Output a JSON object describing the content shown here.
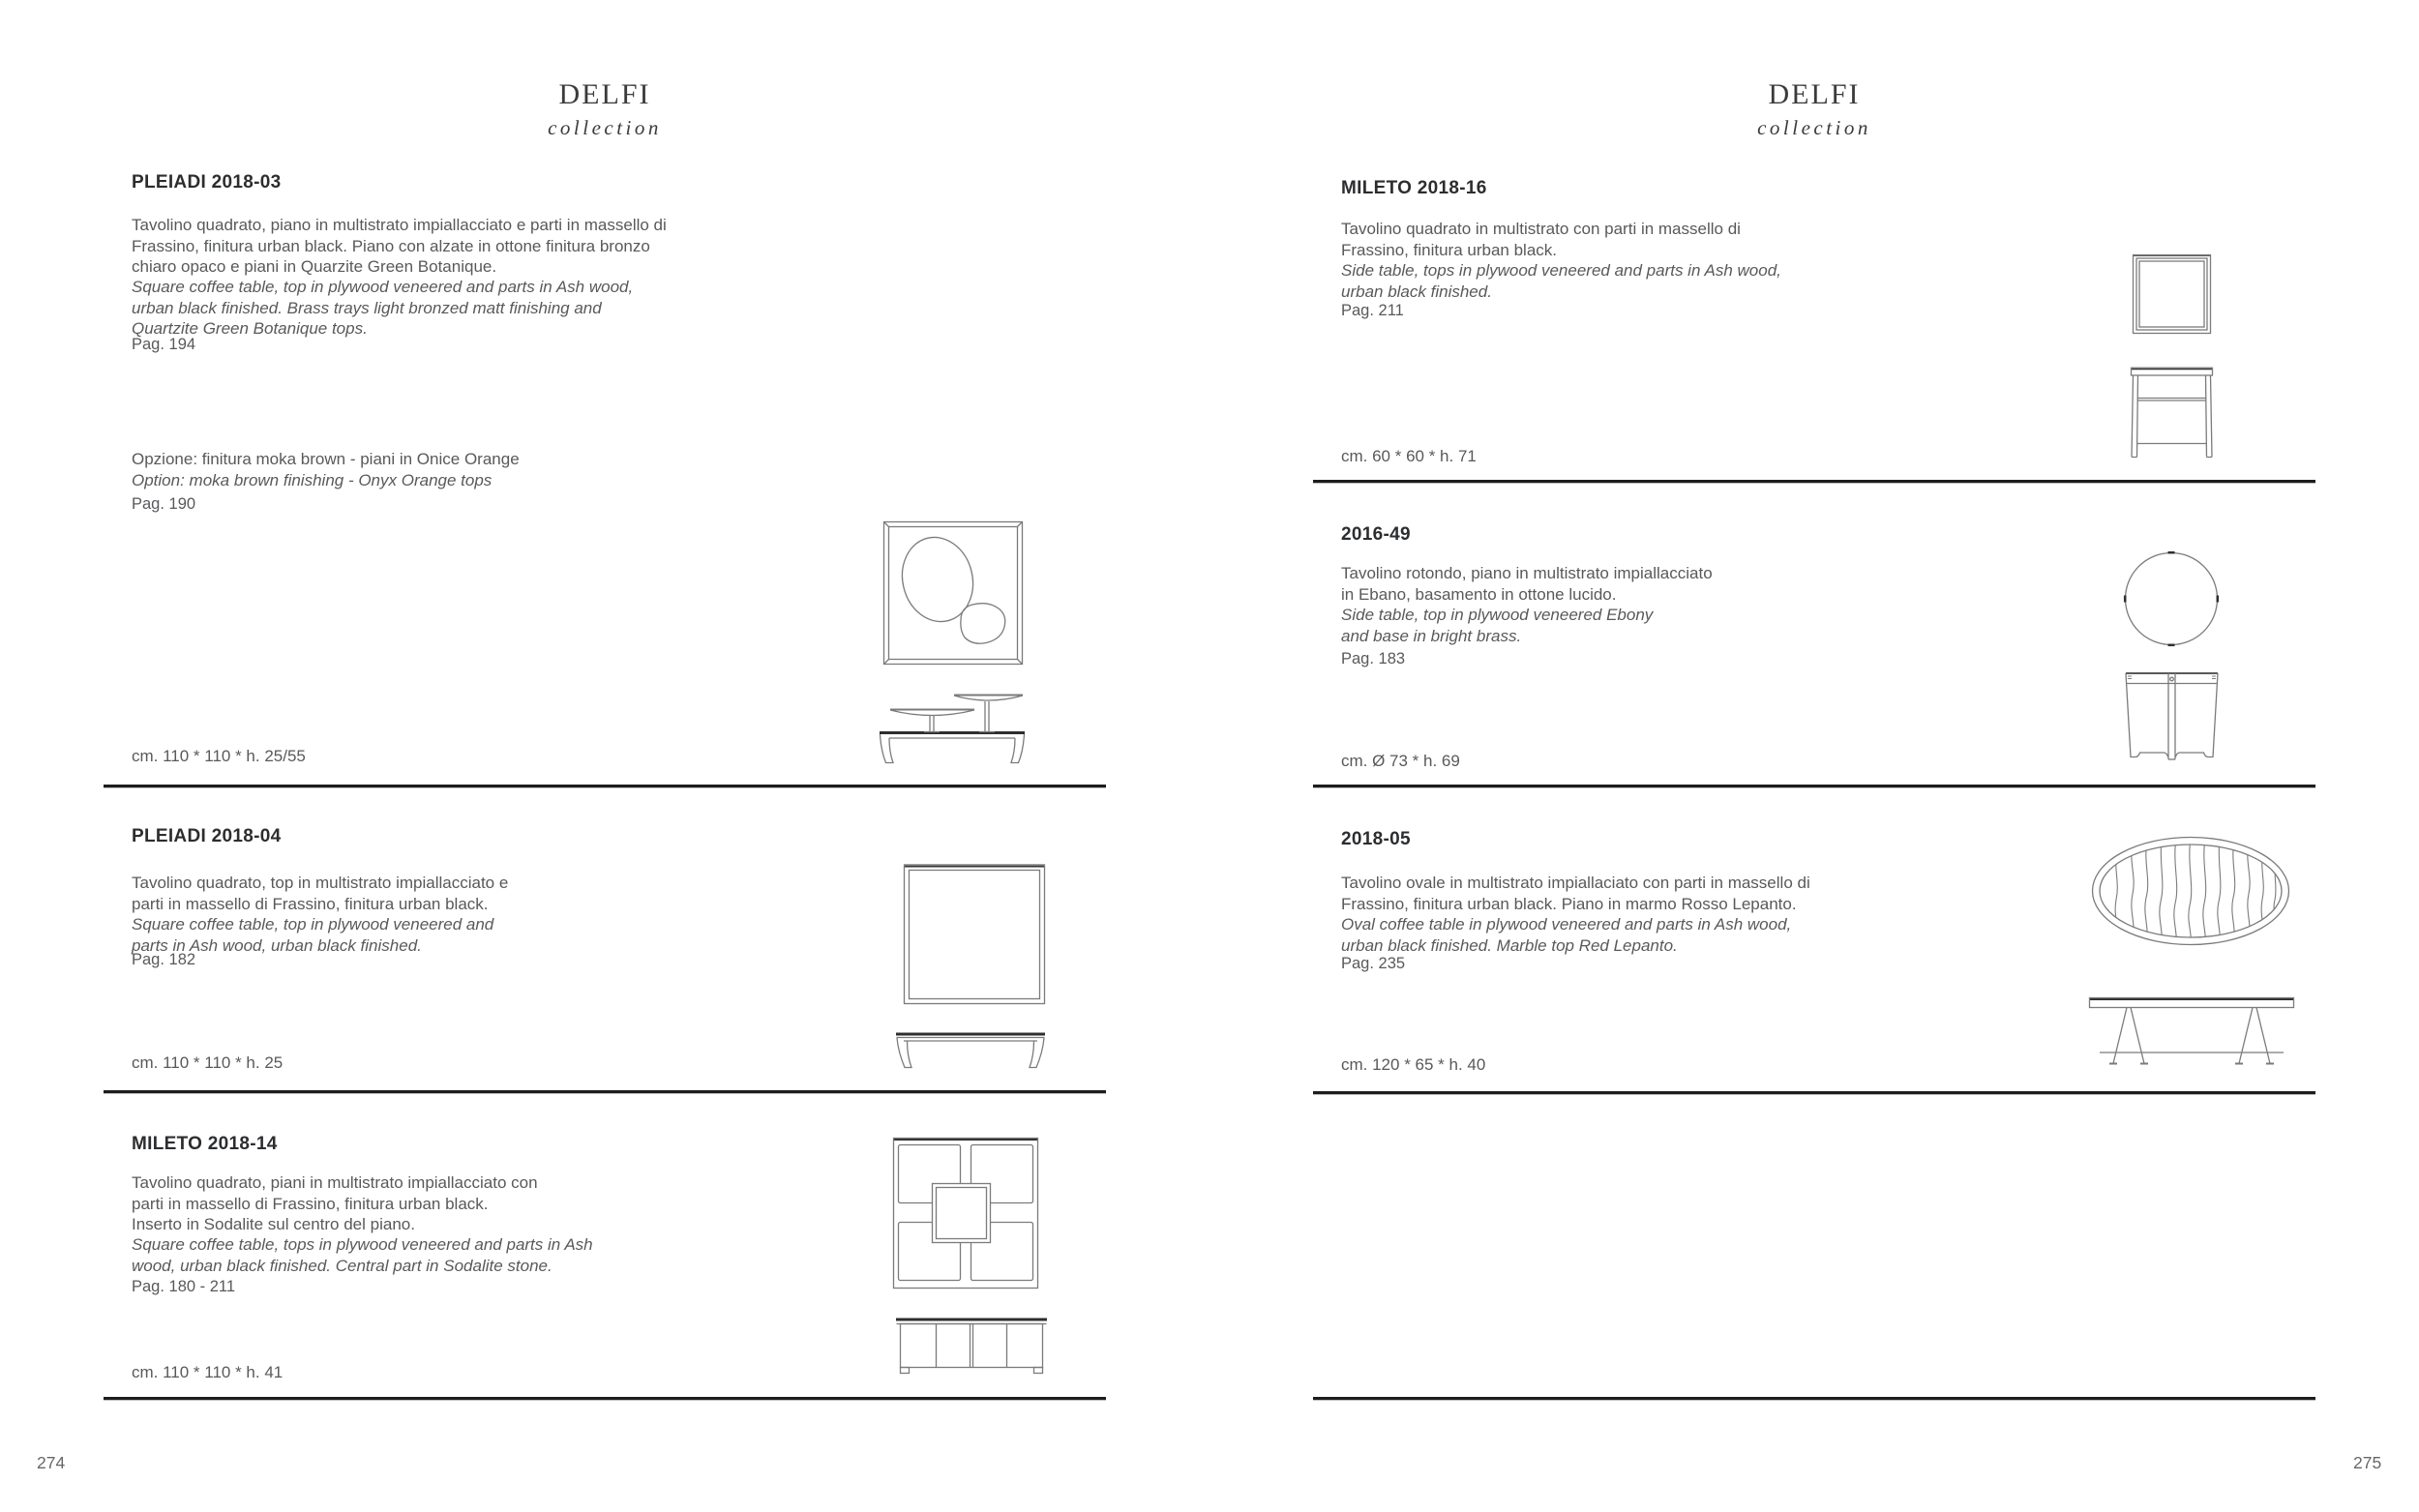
{
  "colors": {
    "text_gray": "#58595b",
    "title_dark": "#2c2d2f",
    "rule_dark": "#1d1d1d",
    "line_art": "#7b7b7b"
  },
  "pages": [
    {
      "page_number": "274",
      "header": {
        "title": "DELFI",
        "subtitle": "collection"
      },
      "sections": [
        {
          "code": "PLEIADI 2018-03",
          "desc_it": [
            "Tavolino quadrato, piano in multistrato impiallacciato e parti in massello di",
            "Frassino, finitura urban black. Piano con alzate in ottone finitura bronzo",
            "chiaro opaco e piani in Quarzite Green Botanique."
          ],
          "desc_en": [
            "Square coffee table, top in plywood veneered and parts in Ash wood,",
            "urban black finished. Brass trays light bronzed matt finishing and",
            "Quartzite Green Botanique tops."
          ],
          "page_ref": "Pag. 194",
          "option": {
            "it": "Opzione: finitura moka brown - piani in Onice Orange",
            "en": "Option: moka brown finishing - Onyx Orange tops",
            "page_ref": "Pag. 190"
          },
          "dimensions": "cm. 110 * 110 * h. 25/55"
        },
        {
          "code": "PLEIADI 2018-04",
          "desc_it": [
            "Tavolino quadrato, top in multistrato impiallacciato e",
            "parti in massello di Frassino, finitura urban black."
          ],
          "desc_en": [
            "Square coffee table, top in plywood veneered and",
            "parts in Ash wood, urban black finished."
          ],
          "page_ref": "Pag. 182",
          "dimensions": "cm. 110 * 110 * h. 25"
        },
        {
          "code": "MILETO 2018-14",
          "desc_it": [
            "Tavolino quadrato, piani in multistrato impiallacciato con",
            "parti in massello di Frassino, finitura urban black.",
            "Inserto in Sodalite sul centro del piano."
          ],
          "desc_en": [
            "Square coffee table, tops in plywood veneered and parts in Ash",
            "wood, urban black finished. Central part in Sodalite stone."
          ],
          "page_ref": "Pag. 180 - 211",
          "dimensions": "cm. 110 * 110 * h. 41"
        }
      ]
    },
    {
      "page_number": "275",
      "header": {
        "title": "DELFI",
        "subtitle": "collection"
      },
      "sections": [
        {
          "code": "MILETO 2018-16",
          "desc_it": [
            "Tavolino quadrato in multistrato con parti in massello di",
            "Frassino, finitura urban black."
          ],
          "desc_en": [
            "Side table, tops in plywood veneered and parts in Ash wood,",
            "urban black finished."
          ],
          "page_ref": "Pag. 211",
          "dimensions": "cm. 60 * 60 * h. 71"
        },
        {
          "code": "2016-49",
          "desc_it": [
            "Tavolino rotondo, piano in multistrato impiallacciato",
            "in Ebano, basamento in ottone lucido."
          ],
          "desc_en": [
            "Side table, top in plywood veneered Ebony",
            "and base in bright brass."
          ],
          "page_ref": "Pag. 183",
          "dimensions": "cm. Ø 73 * h. 69"
        },
        {
          "code": "2018-05",
          "desc_it": [
            "Tavolino ovale in multistrato impiallaciato con parti in massello di",
            "Frassino, finitura urban black. Piano in marmo Rosso Lepanto."
          ],
          "desc_en": [
            "Oval coffee table in plywood veneered and parts in Ash wood,",
            "urban black finished. Marble top Red Lepanto."
          ],
          "page_ref": "Pag. 235",
          "dimensions": "cm. 120 * 65 * h. 40"
        }
      ]
    }
  ]
}
